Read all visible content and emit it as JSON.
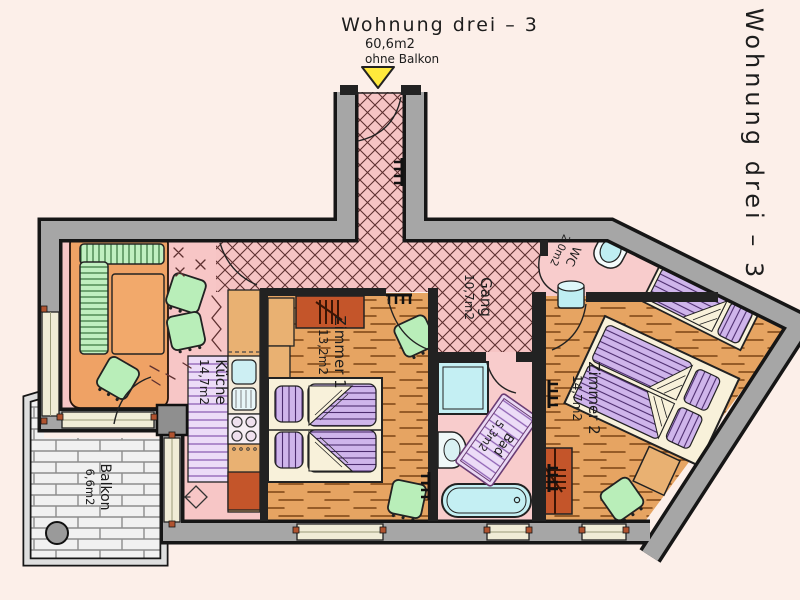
{
  "header": {
    "title": "Wohnung drei – 3",
    "area_total": "60,6m2",
    "note": "ohne Balkon"
  },
  "side_label": "Wohnung drei – 3",
  "rooms": {
    "kueche": {
      "name": "Küche",
      "area": "14,7m2"
    },
    "gang": {
      "name": "Gang",
      "area": "10,7m2"
    },
    "zimmer1": {
      "name": "Zimmer 1",
      "area": "13,2m2"
    },
    "zimmer2": {
      "name": "Zimmer 2",
      "area": "14,7m2"
    },
    "bad": {
      "name": "Bad",
      "area": "5,3m2"
    },
    "wc": {
      "name": "WC",
      "area": "2,0m2"
    },
    "balkon": {
      "name": "Balkon",
      "area": "6,6m2"
    }
  },
  "icons": {
    "entrance_marker": "yellow-triangle-down"
  },
  "palette": {
    "background": "#fcefe9",
    "wall_gray": "#a6a6a6",
    "outline": "#161616",
    "floor_pink": "#f7c6c6",
    "hatch_line": "#5e3030",
    "wood": "#e6a462",
    "wood_line": "#7c4414",
    "furniture_green": "#b9eeb9",
    "mattress_purple": "#cfb5eb",
    "counter_purple": "#ecdcf7",
    "fixture_cyan": "#c4eff3",
    "wardrobe_red": "#c4552a",
    "table_orange": "#efa265",
    "window_cream": "#f0ecd6",
    "marker_yellow": "#ffe93c"
  }
}
